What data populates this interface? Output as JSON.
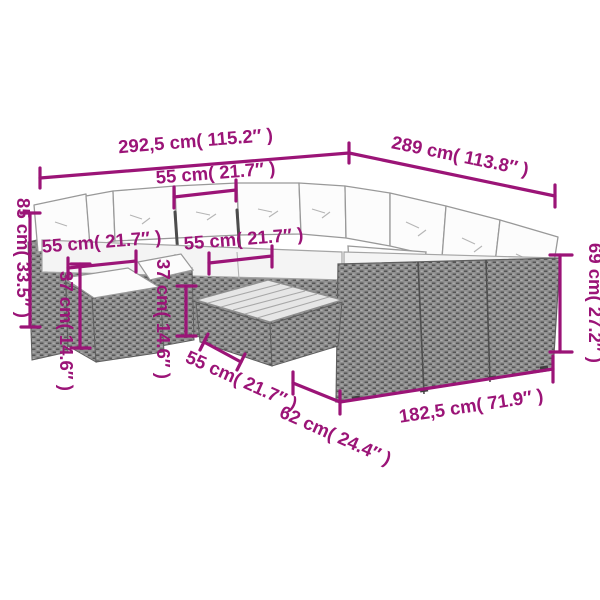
{
  "diagram": {
    "type": "product-dimension-diagram",
    "product": "rattan-garden-lounge-set-with-cushions-footstools-and-table",
    "background_color": "#ffffff",
    "dimension_color": "#9b1477",
    "furniture_colors": {
      "rattan_base": "#8e8e8e",
      "rattan_weave_dark": "#545454",
      "rattan_weave_light": "#bdbdbd",
      "cushion_fill": "#fcfcfc",
      "cushion_outline": "#999999",
      "table_top": "#e6e6e6"
    },
    "dimensions": {
      "total_width": "292,5 cm( 115.2″ )",
      "total_depth": "289 cm( 113.8″ )",
      "seat_width_top": "55 cm( 21.7″ )",
      "seat_width_left": "55 cm( 21.7″ )",
      "seat_width_mid": "55 cm( 21.7″ )",
      "table_width": "55 cm( 21.7″ )",
      "back_height": "85 cm( 33.5″ )",
      "seat_front_height": "69 cm( 27.2″ )",
      "stool_height_left": "37 cm( 14.6″ )",
      "stool_height_mid": "37 cm( 14.6″ )",
      "right_section_length": "182,5 cm( 71.9″ )",
      "section_depth": "62 cm( 24.4″ )"
    }
  }
}
